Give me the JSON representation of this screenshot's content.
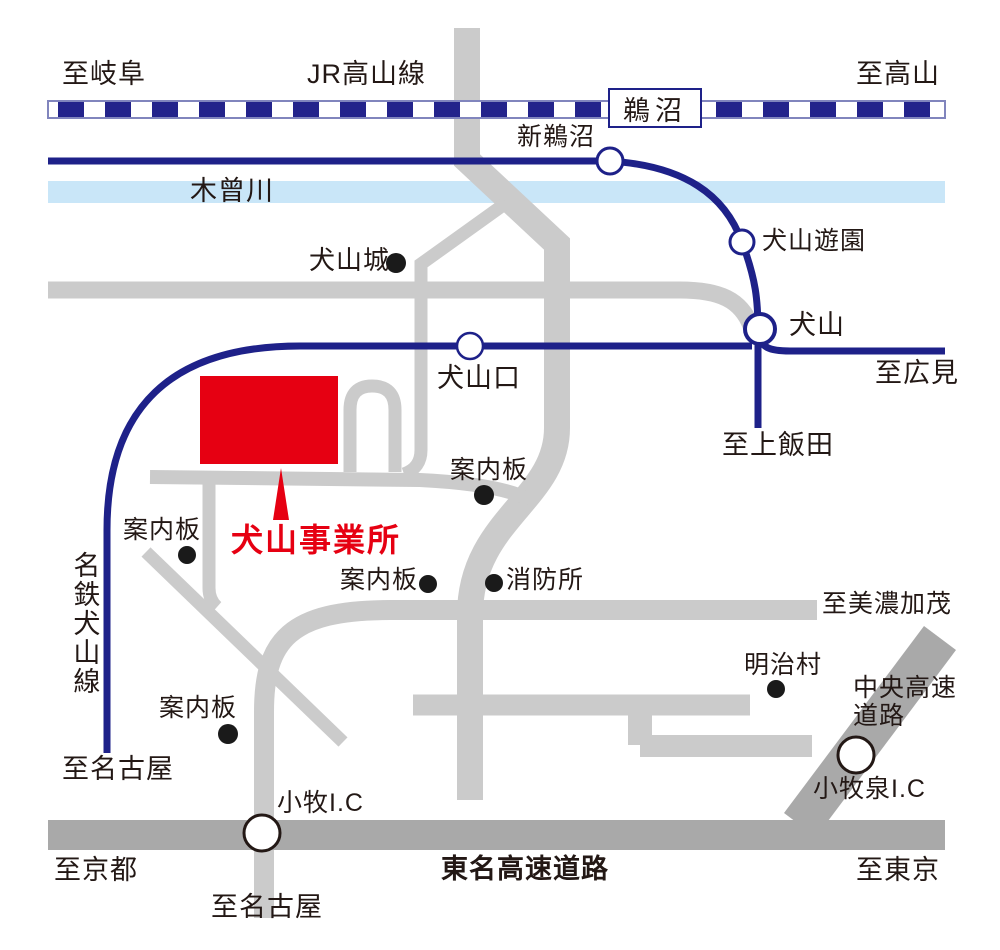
{
  "colors": {
    "rail_blue": "#1e2189",
    "jr_band_outline": "#8185bd",
    "river_blue": "#c9e6f8",
    "road_gray": "#cbcbcb",
    "expressway_gray": "#a9a9a9",
    "accent_red": "#e60012",
    "text_color": "#231815"
  },
  "railways": {
    "jr_takayama": {
      "name": "JR高山線",
      "to_left": "至岐阜",
      "to_right": "至高山",
      "station_unuma": "鵜沼"
    },
    "meitetsu": {
      "name": "名鉄犬山線",
      "station_shin_unuma": "新鵜沼",
      "station_inuyama_yuen": "犬山遊園",
      "station_inuyama": "犬山",
      "station_inuyamaguchi": "犬山口",
      "to_hiromi": "至広見",
      "to_kamiiida": "至上飯田",
      "to_nagoya": "至名古屋"
    }
  },
  "river": {
    "name": "木曾川"
  },
  "office": {
    "name": "犬山事業所"
  },
  "pois": {
    "castle": "犬山城",
    "guide_board": "案内板",
    "fire_station": "消防所",
    "meiji_mura": "明治村"
  },
  "roads": {
    "to_minokamo": "至美濃加茂",
    "chuo_expwy_line1": "中央高速",
    "chuo_expwy_line2": "道路",
    "komaki_izumi_ic": "小牧泉I.C",
    "komaki_ic": "小牧I.C",
    "tomei_expwy": "東名高速道路",
    "to_kyoto": "至京都",
    "to_tokyo": "至東京",
    "to_nagoya": "至名古屋"
  }
}
